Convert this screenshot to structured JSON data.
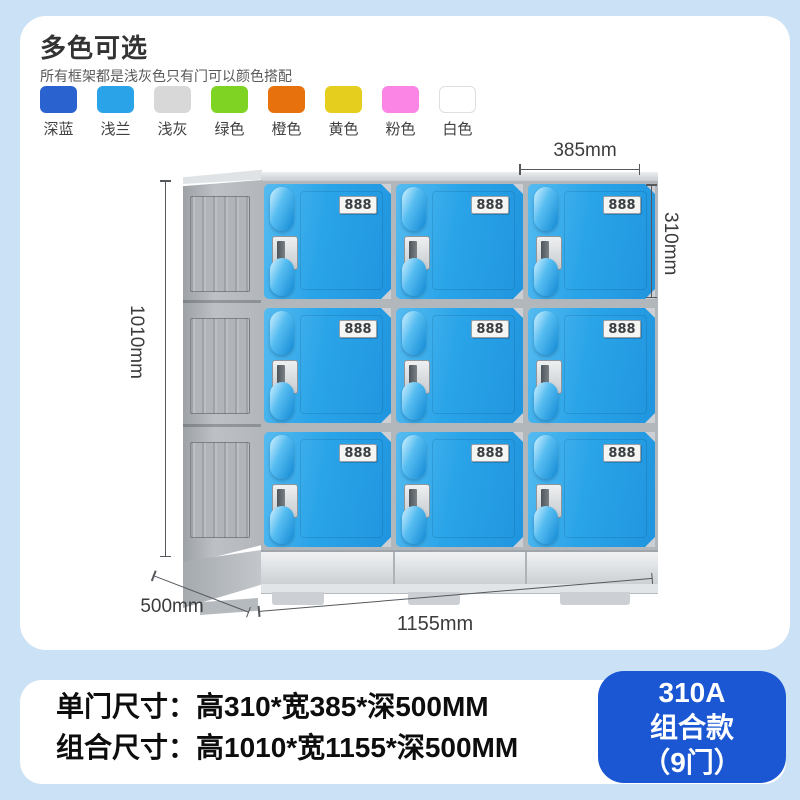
{
  "colors_section": {
    "title": "多色可选",
    "subtitle": "所有框架都是浅灰色只有门可以颜色搭配",
    "swatches": [
      {
        "label": "深蓝",
        "color": "#2a62cf"
      },
      {
        "label": "浅兰",
        "color": "#2aa3e9"
      },
      {
        "label": "浅灰",
        "color": "#d8d8d8"
      },
      {
        "label": "绿色",
        "color": "#7fd322"
      },
      {
        "label": "橙色",
        "color": "#e7710d"
      },
      {
        "label": "黄色",
        "color": "#e5ce1e"
      },
      {
        "label": "粉色",
        "color": "#fb85e5"
      },
      {
        "label": "白色",
        "color": "#ffffff"
      }
    ]
  },
  "diagram": {
    "door_label": "888",
    "door_color": "#2aa4e8",
    "dim_door_width": "385mm",
    "dim_door_height": "310mm",
    "dim_total_height": "1010mm",
    "dim_depth": "500mm",
    "dim_total_width": "1155mm"
  },
  "specs": {
    "single_door": "单门尺寸：高310*宽385*深500MM",
    "combined": "组合尺寸：高1010*宽1155*深500MM"
  },
  "badge": {
    "model": "310A",
    "type": "组合款",
    "doors": "（9门）",
    "color": "#1b57d3"
  }
}
